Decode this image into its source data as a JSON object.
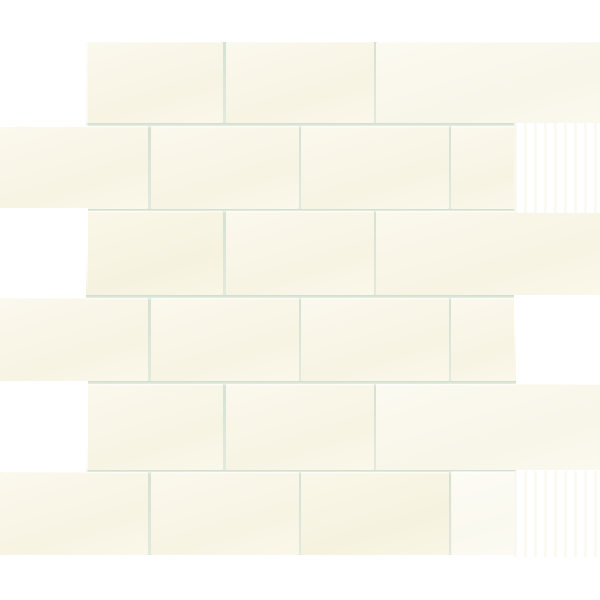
{
  "photo": {
    "subject": "white-glazed ceramic subway tile mosaic sheet, running bond brick pattern",
    "canvas": {
      "width": 600,
      "height": 600
    },
    "background_color": "#FFFFFF"
  },
  "palette": {
    "tile_base": "#FAF7E8",
    "tile_light": "#FBF9ED",
    "tile_warm": "#F9F5E3",
    "grout": "#D9E3D6",
    "grout_dark_edge": "#CFDCCC",
    "grout_light_edge": "#E6EEE1",
    "glare_white": "#FFFFFF"
  },
  "mosaic": {
    "sheet_top": 42,
    "sheet_bottom": 555,
    "grout_thickness": 2.5,
    "h_joints": {
      "x1": 86,
      "x2": 516,
      "y_positions": [
        123,
        208.5,
        295,
        381,
        469.5
      ]
    },
    "rows": [
      {
        "y": 42,
        "h": 81,
        "offset_type": "B",
        "tiles": [
          {
            "x": 86,
            "w": 137,
            "tint": "base"
          },
          {
            "x": 225.5,
            "w": 148,
            "tint": "base"
          },
          {
            "x": 376,
            "w": 224,
            "tint": "light"
          }
        ]
      },
      {
        "y": 125.5,
        "h": 83,
        "offset_type": "A",
        "tiles": [
          {
            "x": 0,
            "w": 148,
            "tint": "base"
          },
          {
            "x": 150.5,
            "w": 148,
            "tint": "base"
          },
          {
            "x": 301,
            "w": 147.5,
            "tint": "base"
          },
          {
            "x": 451,
            "w": 65,
            "tint": "base"
          }
        ]
      },
      {
        "y": 211,
        "h": 84,
        "offset_type": "B",
        "tiles": [
          {
            "x": 86,
            "w": 137,
            "tint": "warm"
          },
          {
            "x": 225.5,
            "w": 148,
            "tint": "base"
          },
          {
            "x": 376,
            "w": 224,
            "tint": "base"
          }
        ]
      },
      {
        "y": 297.5,
        "h": 83.5,
        "offset_type": "A",
        "tiles": [
          {
            "x": 0,
            "w": 148,
            "tint": "base"
          },
          {
            "x": 150.5,
            "w": 148,
            "tint": "base"
          },
          {
            "x": 301,
            "w": 147.5,
            "tint": "base"
          },
          {
            "x": 451,
            "w": 65,
            "tint": "base"
          }
        ]
      },
      {
        "y": 383.5,
        "h": 86,
        "offset_type": "B",
        "tiles": [
          {
            "x": 86,
            "w": 137,
            "tint": "base"
          },
          {
            "x": 225.5,
            "w": 148,
            "tint": "base"
          },
          {
            "x": 376,
            "w": 224,
            "tint": "light"
          }
        ]
      },
      {
        "y": 472,
        "h": 83,
        "offset_type": "A",
        "tiles": [
          {
            "x": 0,
            "w": 148,
            "tint": "base"
          },
          {
            "x": 150.5,
            "w": 148,
            "tint": "base"
          },
          {
            "x": 301,
            "w": 147.5,
            "tint": "warm"
          },
          {
            "x": 451,
            "w": 65,
            "tint": "base"
          }
        ]
      }
    ],
    "glare_patches": [
      {
        "name": "glare-top-left-wash",
        "type": "wash",
        "x": 0,
        "y": 42,
        "w": 88,
        "h": 85
      },
      {
        "name": "glare-top-left-band",
        "type": "band-left",
        "x": 0,
        "y": 42,
        "w": 34,
        "h": 85
      },
      {
        "name": "glare-top-left-square",
        "type": "square",
        "x": 28,
        "y": 70,
        "w": 58,
        "h": 57
      },
      {
        "name": "glare-left-middle",
        "type": "diag-a",
        "x": 0,
        "y": 208,
        "w": 88,
        "h": 88
      },
      {
        "name": "glare-left-lower",
        "type": "diag-b",
        "x": 0,
        "y": 381,
        "w": 88,
        "h": 91
      },
      {
        "name": "glare-right-upper",
        "type": "streaked",
        "x": 514,
        "y": 123,
        "w": 86,
        "h": 90
      },
      {
        "name": "glare-right-middle",
        "type": "diag-c",
        "x": 514,
        "y": 295,
        "w": 86,
        "h": 90
      },
      {
        "name": "glare-right-lower-band",
        "type": "wash-light",
        "x": 452,
        "y": 471,
        "w": 64,
        "h": 86
      },
      {
        "name": "glare-right-lower",
        "type": "streaked",
        "x": 514,
        "y": 471,
        "w": 86,
        "h": 86
      }
    ]
  }
}
